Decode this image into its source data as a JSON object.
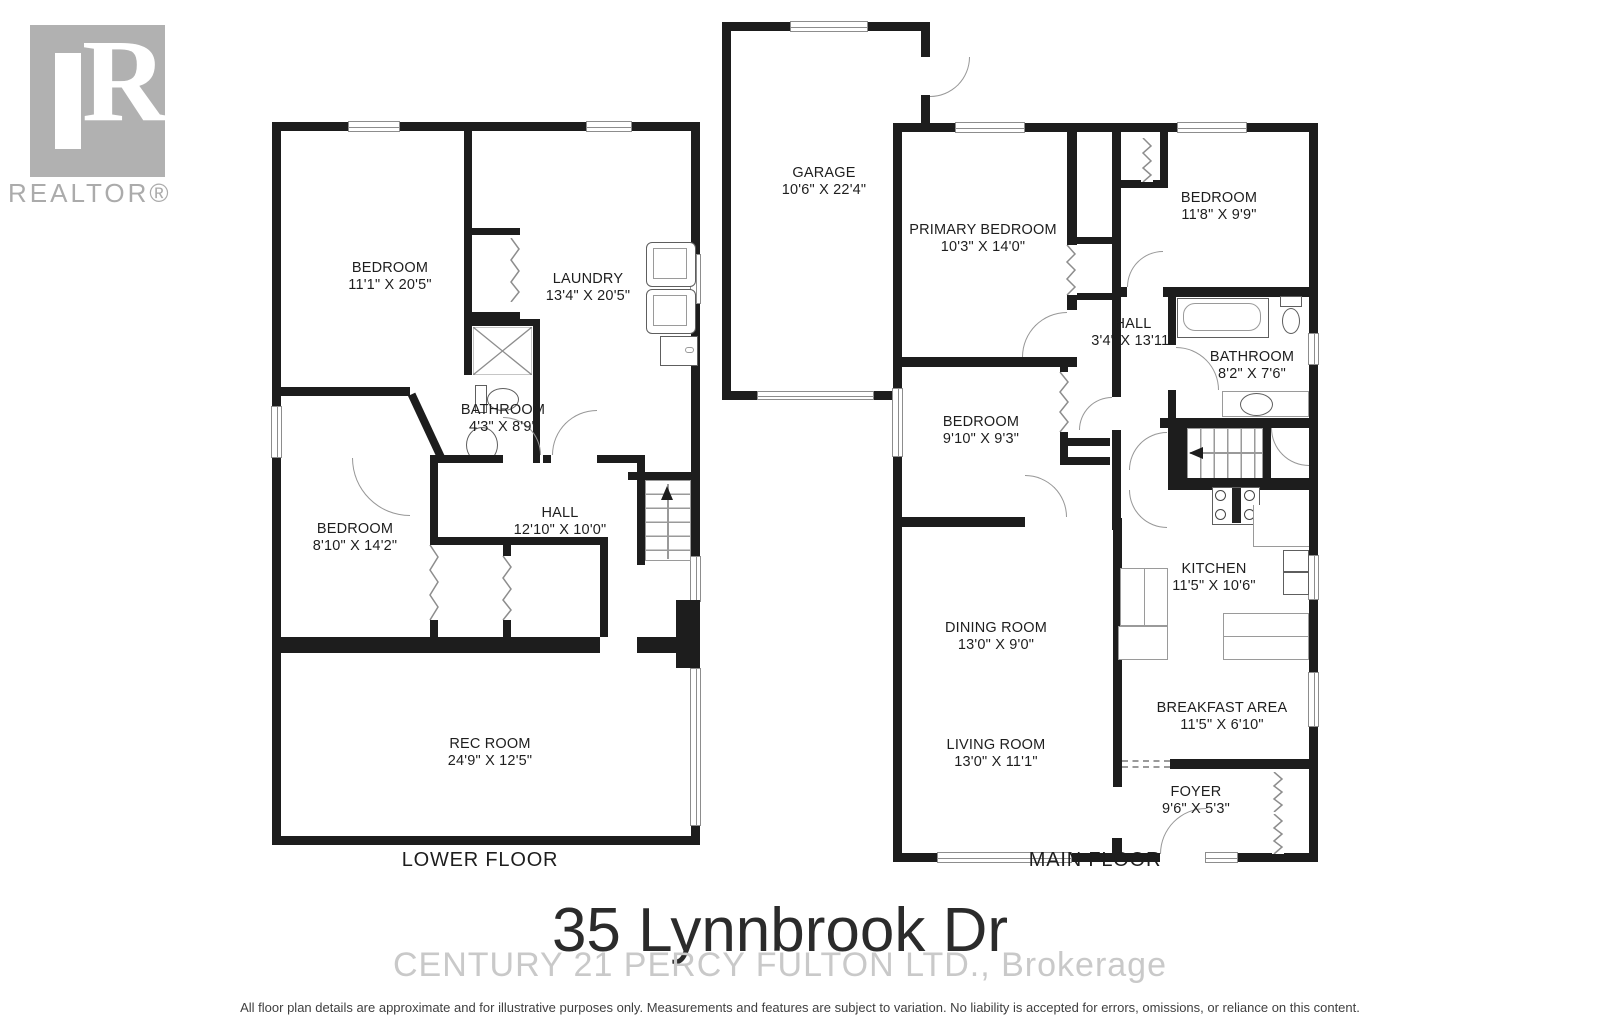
{
  "branding": {
    "logo_r": "R",
    "wordmark": "REALTOR®"
  },
  "title": {
    "address": "35 Lynnbrook Dr",
    "brokerage_watermark": "CENTURY 21 PERCY FULTON LTD., Brokerage"
  },
  "disclaimer": "All floor plan details are approximate and for illustrative purposes only. Measurements and features are subject to variation. No liability is accepted for errors, omissions, or reliance on this content.",
  "floors": {
    "lower": {
      "label": "LOWER FLOOR",
      "rooms": {
        "bedroom1": {
          "name": "BEDROOM",
          "dims": "11'1\" X 20'5\""
        },
        "laundry": {
          "name": "LAUNDRY",
          "dims": "13'4\" X 20'5\""
        },
        "bathroom": {
          "name": "BATHROOM",
          "dims": "4'3\" X 8'9\""
        },
        "bedroom2": {
          "name": "BEDROOM",
          "dims": "8'10\" X 14'2\""
        },
        "hall": {
          "name": "HALL",
          "dims": "12'10\" X 10'0\""
        },
        "rec": {
          "name": "REC ROOM",
          "dims": "24'9\" X 12'5\""
        }
      }
    },
    "main": {
      "label": "MAIN FLOOR",
      "rooms": {
        "garage": {
          "name": "GARAGE",
          "dims": "10'6\" X 22'4\""
        },
        "primary": {
          "name": "PRIMARY BEDROOM",
          "dims": "10'3\" X 14'0\""
        },
        "bedroom3": {
          "name": "BEDROOM",
          "dims": "11'8\" X 9'9\""
        },
        "hall": {
          "name": "HALL",
          "dims": "3'4\" X 13'11\""
        },
        "bathroom": {
          "name": "BATHROOM",
          "dims": "8'2\" X 7'6\""
        },
        "bedroom4": {
          "name": "BEDROOM",
          "dims": "9'10\" X 9'3\""
        },
        "kitchen": {
          "name": "KITCHEN",
          "dims": "11'5\" X 10'6\""
        },
        "dining": {
          "name": "DINING ROOM",
          "dims": "13'0\" X 9'0\""
        },
        "breakfast": {
          "name": "BREAKFAST AREA",
          "dims": "11'5\" X 6'10\""
        },
        "living": {
          "name": "LIVING ROOM",
          "dims": "13'0\" X 11'1\""
        },
        "foyer": {
          "name": "FOYER",
          "dims": "9'6\" X 5'3\""
        }
      }
    }
  }
}
